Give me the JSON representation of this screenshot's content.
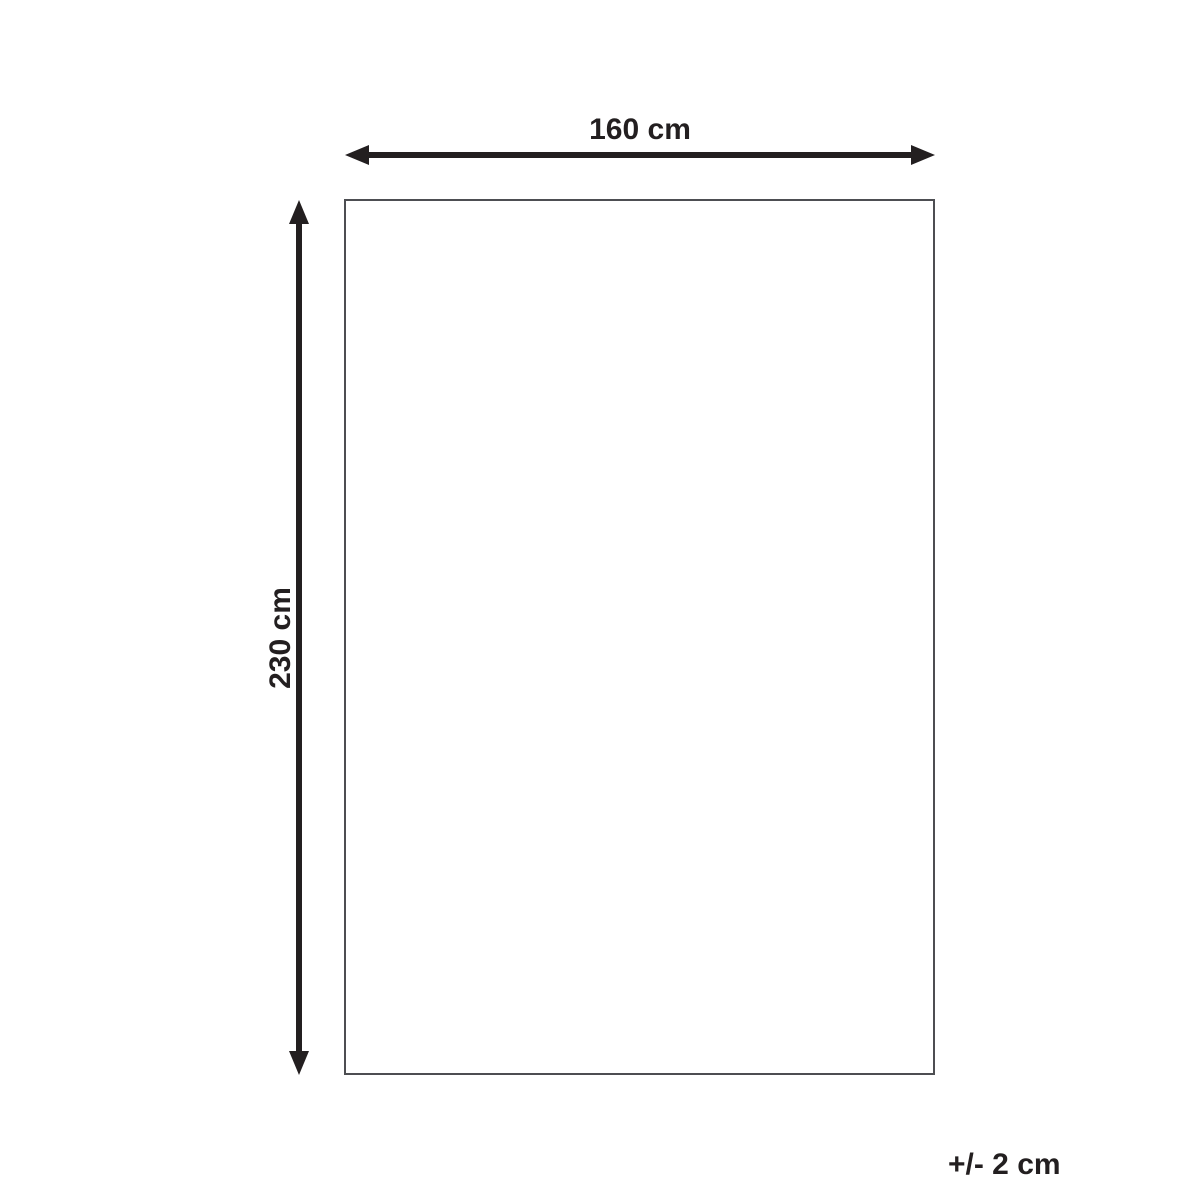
{
  "diagram": {
    "width_label": "160 cm",
    "height_label": "230 cm",
    "tolerance_label": "+/- 2 cm",
    "shape": "rectangle-outline"
  },
  "icons": {
    "width_arrow": "double-headed-horizontal-arrow",
    "height_arrow": "double-headed-vertical-arrow"
  },
  "colors": {
    "ink": "#231f20",
    "outline": "#4d4e52",
    "background": "#ffffff"
  }
}
